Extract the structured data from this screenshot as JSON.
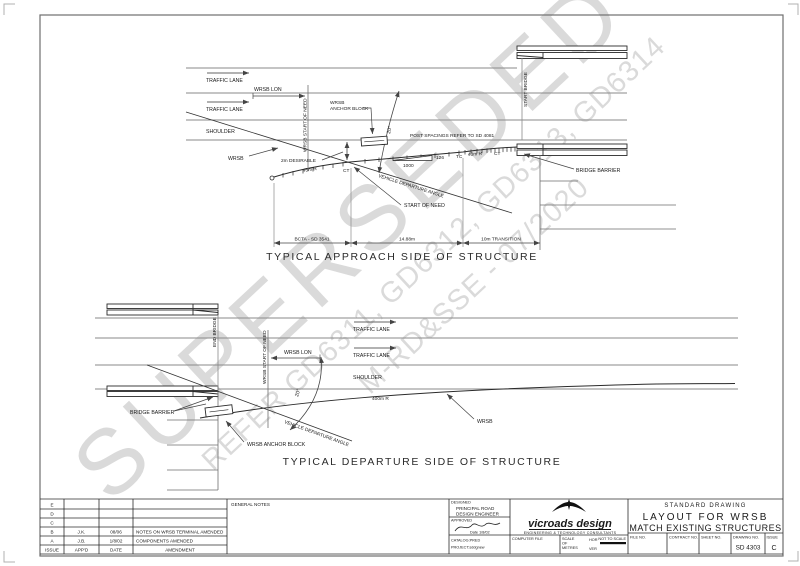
{
  "watermark": {
    "line1": "SUPERSEDED",
    "line2": "REFER GD6311, GD6312, GD6313, GD6314",
    "line3": "M-RD&SSE - 07/2020"
  },
  "colors": {
    "line": "#333333",
    "watermark": "#d4d4d4"
  },
  "approach": {
    "traffic_lane_1": "TRAFFIC LANE",
    "traffic_lane_2": "TRAFFIC LANE",
    "shoulder": "SHOULDER",
    "wrsb_lon": "WRSB LON",
    "wrsb_start_of_need": "WRSB START OF NEED",
    "start_bridge": "START BRIDGE",
    "anchor_block_1": "WRSB",
    "anchor_block_2": "ANCHOR BLOCK",
    "wrsb": "WRSB",
    "desirable": "2m DESIRABLE",
    "radius_left": "45m R",
    "ct_left": "CT",
    "angle": "20°",
    "post_spacings": "POST SPACINGS REFER TO SD 4081",
    "taper_rise": "126",
    "taper_run": "1000",
    "tc": "TC",
    "radius_right": "40m R",
    "ct_right": "CT",
    "vehicle_departure_angle": "VEHICLE DEPARTURE ANGLE",
    "start_of_need": "START OF NEED",
    "bridge_barrier": "BRIDGE BARRIER",
    "dim_bcta": "BCTA - SD 3541",
    "dim_length": "14.88m",
    "dim_transition": "10m TRANSITION",
    "title": "TYPICAL APPROACH SIDE OF STRUCTURE"
  },
  "departure": {
    "end_bridge": "END BRIDGE",
    "wrsb_start_of_need": "WRSB START OF NEED",
    "wrsb_lon": "WRSB LON",
    "traffic_lane_1": "TRAFFIC LANE",
    "traffic_lane_2": "TRAFFIC LANE",
    "shoulder": "SHOULDER",
    "angle": "20°",
    "radius": "400m R",
    "vehicle_departure_angle": "VEHICLE DEPARTURE ANGLE",
    "bridge_barrier": "BRIDGE BARRIER",
    "wrsb_anchor_block": "WRSB ANCHOR BLOCK",
    "wrsb": "WRSB",
    "title": "TYPICAL DEPARTURE SIDE OF STRUCTURE"
  },
  "title_block": {
    "revisions": {
      "headers": {
        "issue": "ISSUE",
        "approved": "APP'D",
        "date": "DATE",
        "amendment": "AMENDMENT"
      },
      "rows": [
        {
          "issue": "E",
          "approved": "",
          "date": "",
          "amendment": ""
        },
        {
          "issue": "D",
          "approved": "",
          "date": "",
          "amendment": ""
        },
        {
          "issue": "C",
          "approved": "",
          "date": "",
          "amendment": ""
        },
        {
          "issue": "B",
          "approved": "J.K.",
          "date": "08/06",
          "amendment": "NOTES ON WRSB TERMINAL AMENDED"
        },
        {
          "issue": "A",
          "approved": "J.B.",
          "date": "1/8/02",
          "amendment": "COMPONENTS AMENDED"
        }
      ]
    },
    "general_notes": "GENERAL NOTES",
    "designed_label": "DESIGNED",
    "designed_value_1": "PRINCIPAL ROAD",
    "designed_value_2": "DESIGN ENGINEER",
    "approved_label": "APPROVED",
    "approved_date": "Date 1/8/02",
    "catalog": "CATALOG:PRED",
    "project": "PROJECT:sddgnew",
    "logo_name": "vicroads design",
    "logo_tagline": "ENGINEERING & TECHNOLOGY CONSULTANTS",
    "computer_file": "COMPUTER FILE",
    "scale_1": "SCALE",
    "scale_2": "OF",
    "scale_3": "METRES",
    "hor": "HOR",
    "ver": "VER",
    "not_to_scale": "NOT TO SCALE",
    "standard_drawing": "STANDARD DRAWING",
    "drawing_title_1": "LAYOUT FOR WRSB",
    "drawing_title_2": "MATCH EXISTING STRUCTURES",
    "file_no": "FILE NO.",
    "contract_no": "CONTRACT NO.",
    "sheet_no": "SHEET NO.",
    "drawing_no_label": "DRAWING NO.",
    "drawing_no": "SD 4303",
    "issue_label": "ISSUE",
    "issue": "C"
  }
}
